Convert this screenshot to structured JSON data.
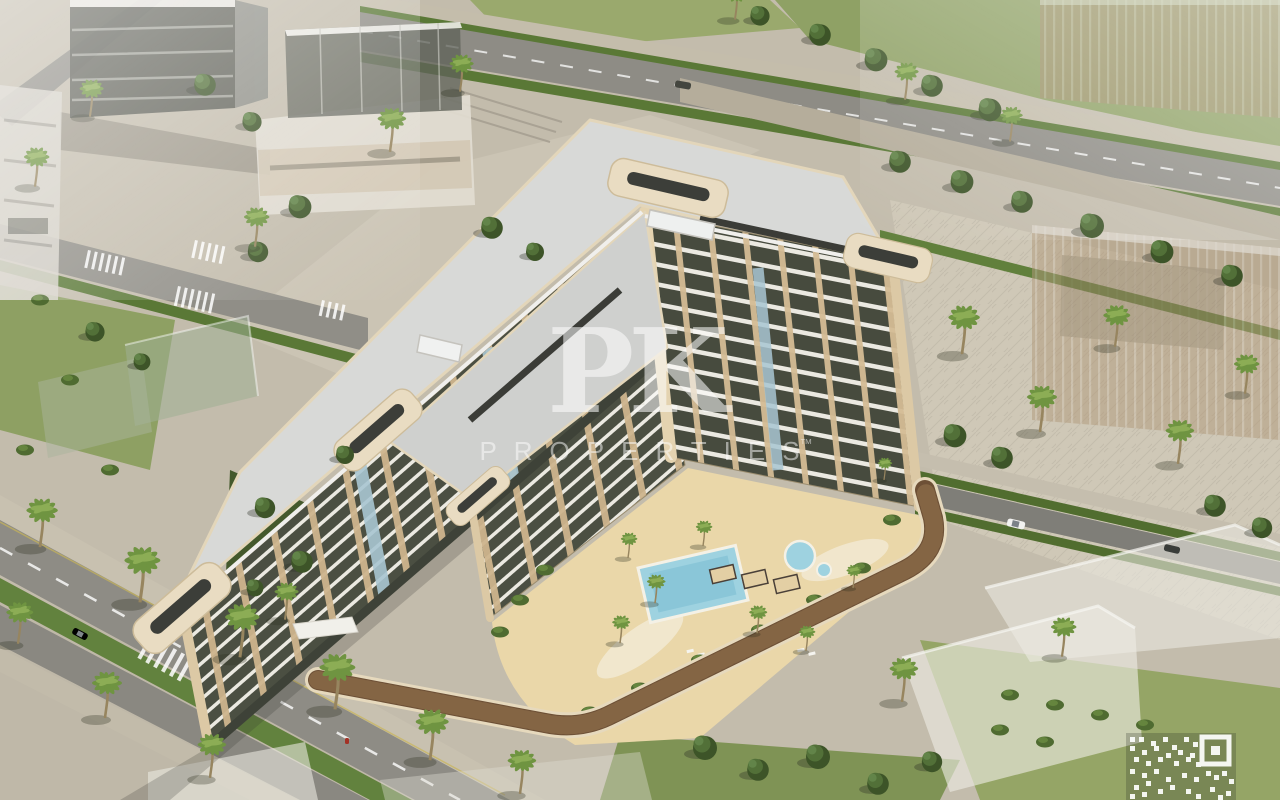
{
  "scene": {
    "kind": "aerial-3d-architectural-render",
    "subject": "Cream residential apartment complex with balcony facades, grey flat roof, podium courtyard with swimming pools, palm-lined streets and translucent context buildings",
    "watermark": {
      "logo": "PK",
      "wordmark": "PROPERTIES",
      "trademark_symbol": "™",
      "color": "#ffffff"
    },
    "qr_code": {
      "present": true,
      "location": "bottom-right corner",
      "style": "white semi-transparent, cropped by image edge"
    },
    "vehicles": {
      "white_cars": 2,
      "dark_cars": 2
    },
    "palette": {
      "facade_pier_cream": "#cdb48d",
      "balcony_white": "#ebe9e1",
      "glass_dark": "#4b4f42",
      "roof_grey": "#d8d9d7",
      "roof_trim_cream": "#e9dcc2",
      "pool_blue": "#9ed2e0",
      "deck_sand": "#ead7a9",
      "podium_brown": "#6d5036",
      "asphalt_grey": "#8e8c85",
      "paving_tan": "#c3bcac",
      "lawn_green": "#9aa96d",
      "hedge_green": "#56743a",
      "palm_green": "#6f9441",
      "watermark_white": "#ffffff"
    }
  }
}
